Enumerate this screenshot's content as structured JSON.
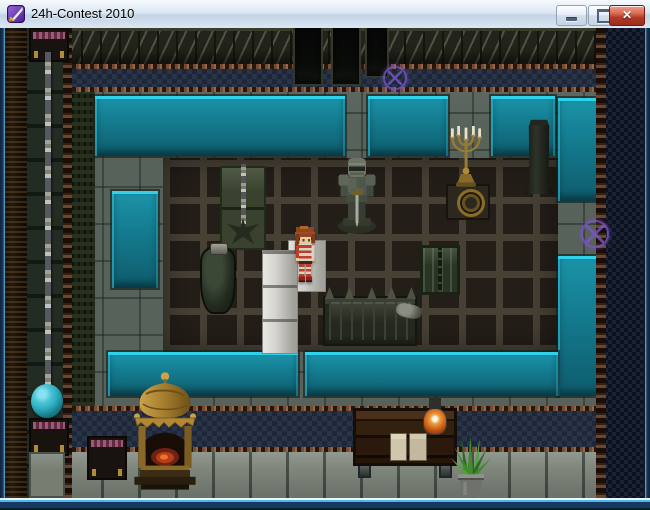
{
  "window": {
    "title": "24h-Contest 2010",
    "icon": "sword-game-icon",
    "controls": {
      "minimize": "Minimize",
      "maximize": "Maximize",
      "close": "Close"
    },
    "close_glyph": "✕"
  },
  "colors": {
    "titlebar_top": "#f6fafd",
    "titlebar_mid": "#dbe7f3",
    "titlebar_bottom": "#c3d3e4",
    "title_text": "#000000",
    "btn_border": "#93a3b5",
    "close_top": "#efa08f",
    "close_bottom": "#b03a28",
    "close_border": "#731a10",
    "frame_dark": "#17395f",
    "frame_cyan": "#4db8e8",
    "frame_light": "#eaf5fc",
    "pool": "#157e92",
    "pool_deep": "#0e5c6c",
    "pool_edge": "#2fd2ec",
    "rune": "#7a55cc",
    "orb": "#2fb0c2",
    "gold": "#b08c34",
    "stone": "#57625a",
    "grid_frame": "#474135",
    "grid_cell": "#241e19",
    "walkway": "#1e2738",
    "walkway_check": "#2a3448",
    "stud": "#744c34",
    "floor": "#7f877d",
    "wall_brown": "#241a0e",
    "white_tile": "#d6d5cf",
    "glow": "#d06018",
    "banner": "#0a0c0a"
  },
  "scene": {
    "objects": [
      "knight statue",
      "gold candelabra with white candles",
      "gold emblem floor tile",
      "dark stone obelisk",
      "hanging chain over mossy tiles",
      "dark ceramic jar",
      "wooden crate",
      "spiked stone railing",
      "player character in red-white striped outfit",
      "white tile path",
      "teal water pools",
      "purple rune circles",
      "black wall banners",
      "chain with teal orb and pedestal",
      "gold lantern shrine with ember glow",
      "wooden bookshelf desk with two books",
      "oil lamp with orange glass",
      "potted aloe plant",
      "small altar table"
    ]
  }
}
